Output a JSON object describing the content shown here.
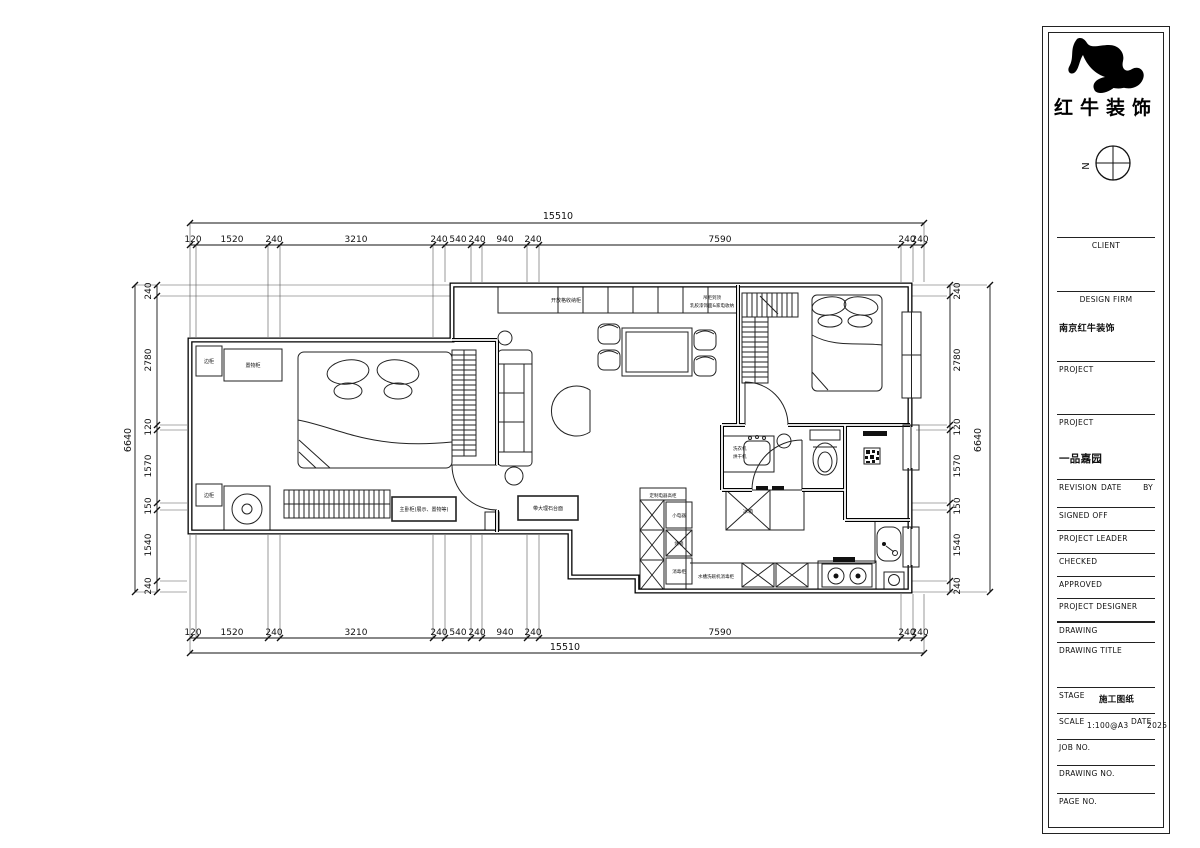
{
  "brand": {
    "logo_text": "红牛装饰"
  },
  "compass": {
    "north": "N"
  },
  "title_block": {
    "client_label": "CLIENT",
    "design_firm_label": "DESIGN FIRM",
    "design_firm_value": "南京红牛装饰",
    "project_label_1": "PROJECT",
    "project_label_2": "PROJECT",
    "project_name": "一品嘉园",
    "revision_label": "REVISION",
    "date_label": "DATE",
    "by_label": "BY",
    "signed_off_label": "SIGNED OFF",
    "project_leader_label": "PROJECT LEADER",
    "checked_label": "CHECKED",
    "approved_label": "APPROVED",
    "project_designer_label": "PROJECT DESIGNER",
    "drawing_label": "DRAWING",
    "drawing_title_label": "DRAWING TITLE",
    "stage_label": "STAGE",
    "stage_value": "施工图纸",
    "scale_label": "SCALE",
    "scale_value": "1:100@A3",
    "date_field_label": "DATE",
    "date_value": "2025",
    "job_no_label": "JOB NO.",
    "drawing_no_label": "DRAWING NO.",
    "page_no_label": "PAGE NO."
  },
  "dims": {
    "top_overall": "15510",
    "bottom_overall": "15510",
    "left_overall": "6640",
    "right_overall": "6640",
    "h_segments": [
      "120",
      "1520",
      "240",
      "3210",
      "240",
      "540",
      "240",
      "940",
      "240",
      "7590",
      "240",
      "240"
    ],
    "v_segments": [
      "240",
      "2780",
      "120",
      "1570",
      "150",
      "1540",
      "240"
    ]
  },
  "plan_labels": {
    "cabinet_row": "开放格收纳柜",
    "cabinet_row2_line1": "吊柜到顶",
    "cabinet_row2_line2": "乳胶漆饰面&家电收纳",
    "side_cabinet_tl": "边柜",
    "storage_tl": "置物柜",
    "side_cabinet_bl": "边柜",
    "master_cabinet": "主卧柜(展示、置物等)",
    "marble_cabinet": "带大理石台面",
    "washer_line1": "洗衣机",
    "washer_line2": "烘干机",
    "tall_unit": "定制电器高柜",
    "small_appliance": "小电器",
    "oven": "烤箱",
    "sterilizer": "消毒柜",
    "sink_row": "水槽洗碗机消毒柜",
    "fridge": "冰箱"
  }
}
